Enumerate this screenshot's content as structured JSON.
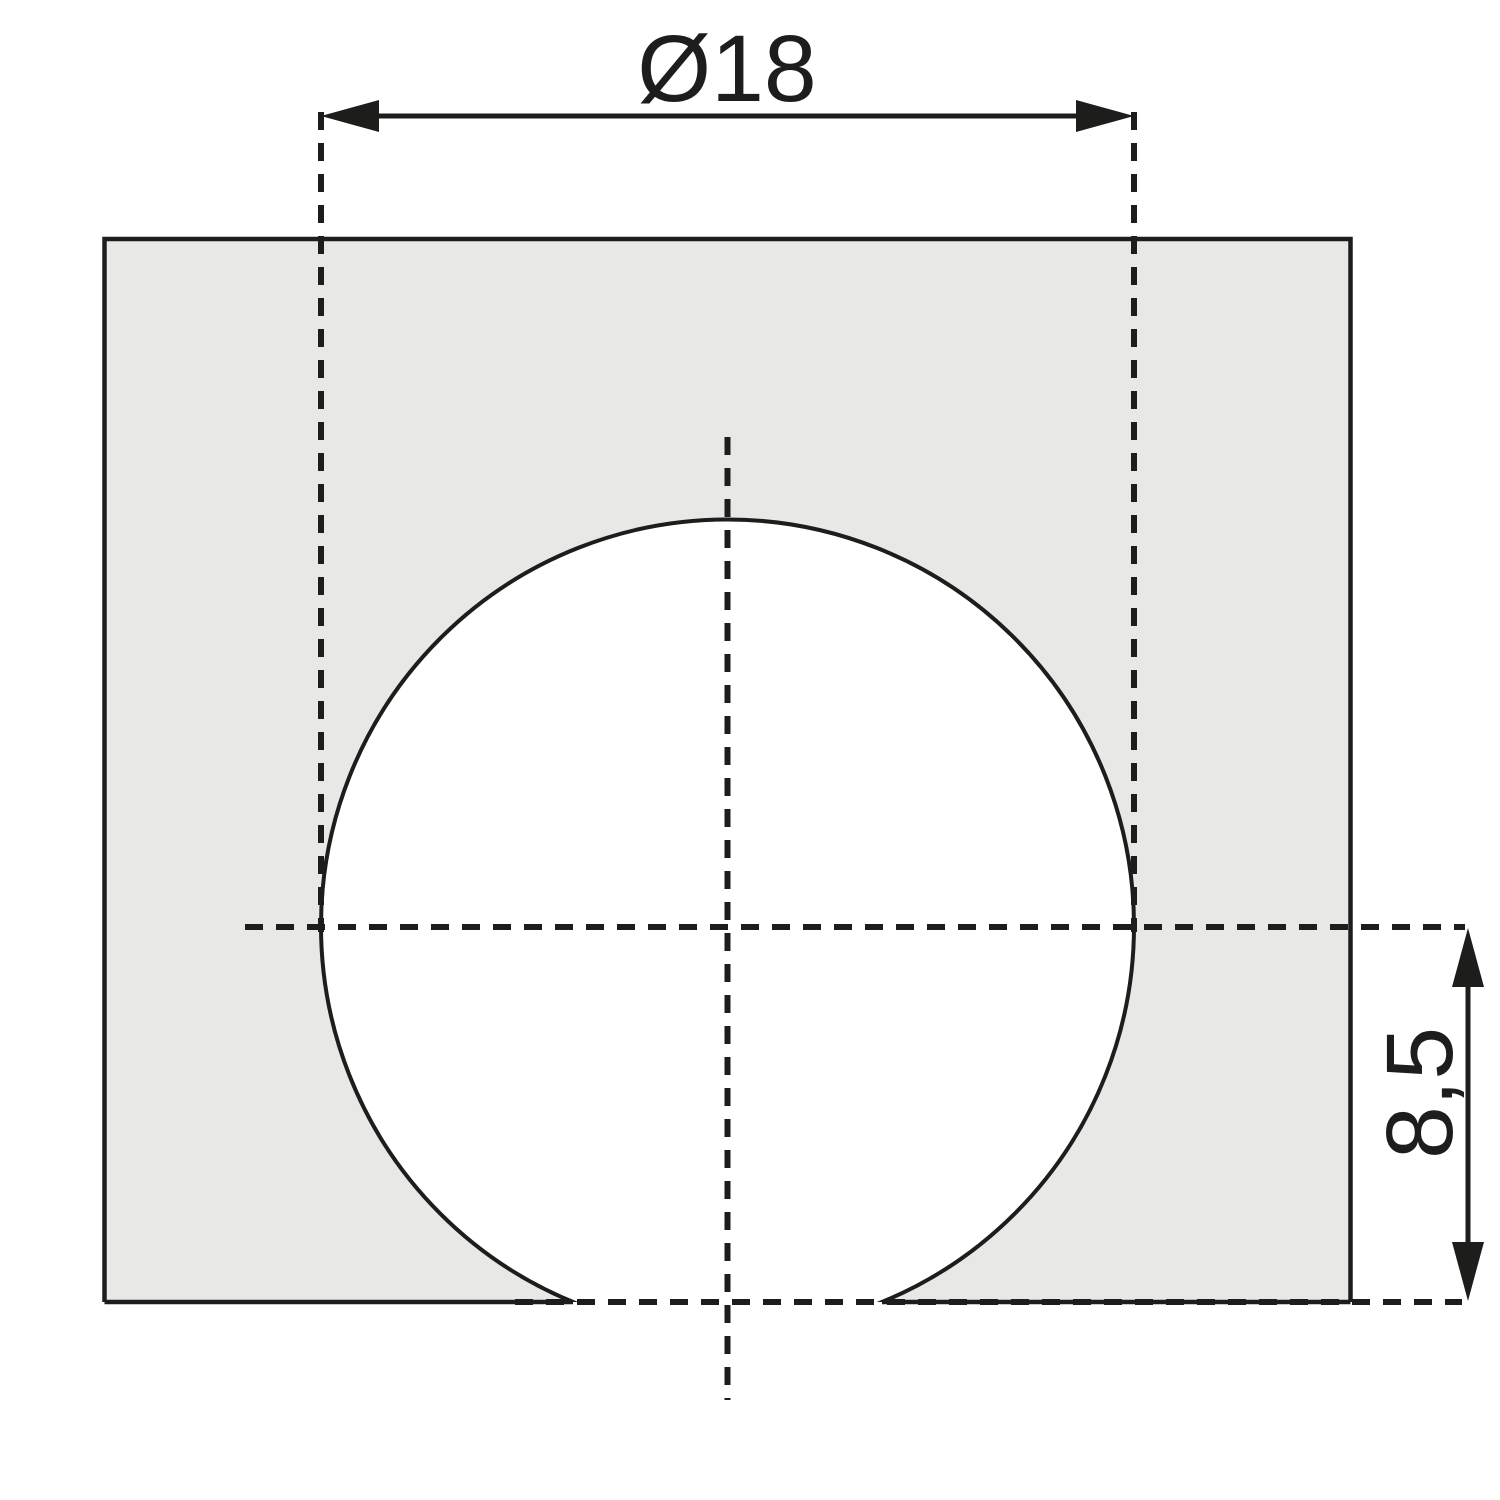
{
  "colors": {
    "line": "#1d1d1b",
    "panel_fill": "#e8e8e7",
    "hole_fill": "#ffffff",
    "background": "#ffffff"
  },
  "dimensions": {
    "diameter": {
      "label": "Ø18",
      "value": 18
    },
    "edge_distance": {
      "label": "8,5",
      "value": 8.5
    }
  }
}
